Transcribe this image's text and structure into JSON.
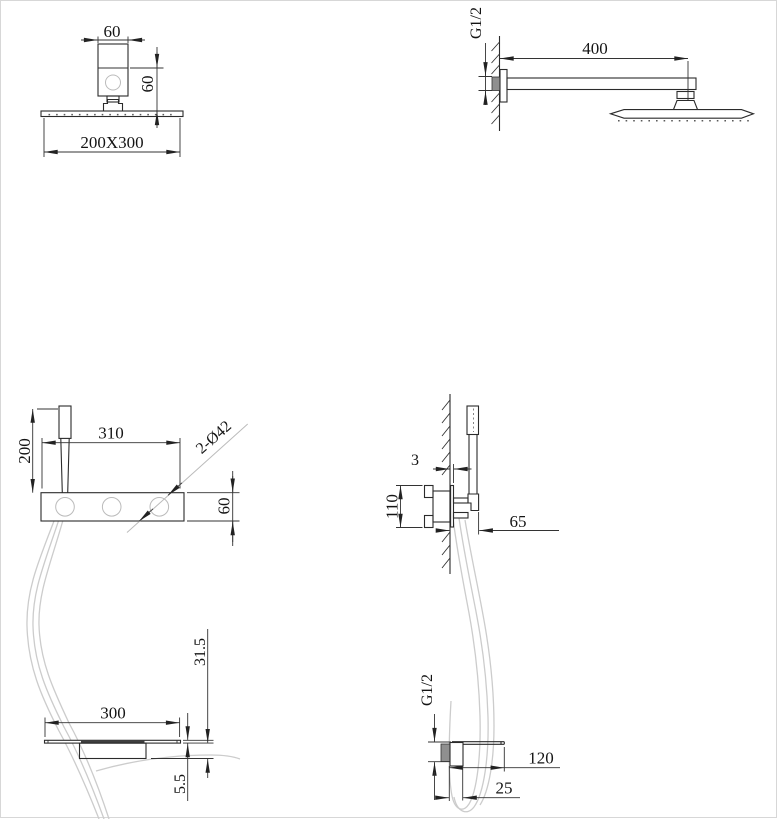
{
  "drawing": {
    "type": "technical-dimension-drawing",
    "subject": "shower set installation dimensions",
    "colors": {
      "line": "#2b2b2b",
      "dim": "#333333",
      "hose": "#cccccc",
      "metal_fill": "#8f8f8f",
      "slot_fill": "#3f3f3f",
      "light_detail": "#bbbbbb"
    },
    "views": {
      "ceiling_head_front": {
        "labels": {
          "bracket_width": "60",
          "drop_height": "60",
          "head_size": "200X300"
        }
      },
      "shower_arm_side": {
        "labels": {
          "inlet_thread": "G1/2",
          "arm_length": "400"
        }
      },
      "panel_front": {
        "labels": {
          "handshower_height": "200",
          "panel_length": "310",
          "knob_note": "2-Ø42",
          "panel_height": "60"
        }
      },
      "panel_side": {
        "labels": {
          "plate_thickness": "3",
          "valve_body_height": "110",
          "panel_depth": "65"
        }
      },
      "spout_front": {
        "labels": {
          "spout_drop": "31.5",
          "spout_width": "300",
          "plate_thickness": "5.5"
        }
      },
      "spout_side": {
        "labels": {
          "inlet_thread": "G1/2",
          "spout_length": "120",
          "spout_depth": "25"
        }
      }
    }
  }
}
